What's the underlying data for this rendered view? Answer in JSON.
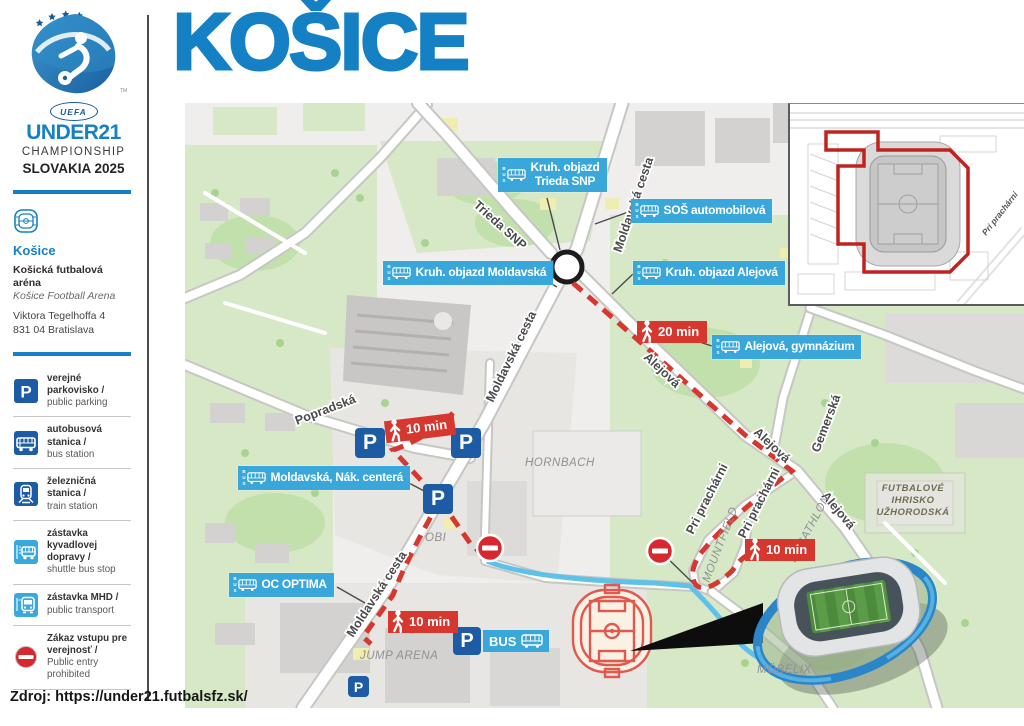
{
  "title": "KOŠICE",
  "footer": {
    "source": "Zdroj: https://under21.futbalsfz.sk/"
  },
  "sidebar": {
    "logo": {
      "uefa": "UEFA",
      "competition": "UNDER21",
      "subtitle": "CHAMPIONSHIP",
      "edition": "SLOVAKIA 2025",
      "trademark": "TM"
    },
    "venue": {
      "city": "Košice",
      "name_sk": "Košická futbalová aréna",
      "name_en": "Košice Football Arena",
      "address_line1": "Viktora Tegelhoffa 4",
      "address_line2": "831 04 Bratislava"
    },
    "legend": {
      "items": [
        {
          "icon": "parking-icon",
          "label_sk": "verejné parkovisko /",
          "label_en": "public parking"
        },
        {
          "icon": "bus-station-icon",
          "label_sk": "autobusová stanica /",
          "label_en": "bus station"
        },
        {
          "icon": "train-station-icon",
          "label_sk": "železničná stanica /",
          "label_en": "train station"
        },
        {
          "icon": "shuttle-bus-stop-icon",
          "label_sk": "zástavka kyvadlovej dopravy /",
          "label_en": "shuttle bus stop"
        },
        {
          "icon": "public-transport-icon",
          "label_sk": "zástavka MHD /",
          "label_en": "public transport"
        },
        {
          "icon": "no-entry-icon",
          "label_sk": "Zákaz vstupu pre verejnosť /",
          "label_en": "Public entry prohibited"
        }
      ]
    }
  },
  "map": {
    "bus_icon_letters": "BUS",
    "parking": {
      "p": "P",
      "bus": "BUS"
    },
    "stops": {
      "trieda_snp": {
        "line1": "Kruh. objazd",
        "line2": "Trieda SNP"
      },
      "sos_automobilova": {
        "line1": "SOŠ automobilová"
      },
      "kruh_moldavska": {
        "line1": "Kruh. objazd Moldavská"
      },
      "kruh_alejova": {
        "line1": "Kruh. objazd Alejová"
      },
      "alejova_gymnazium": {
        "line1": "Alejová, gymnázium"
      },
      "moldavska_nak_centera": {
        "line1": "Moldavská, Nák. centerá"
      },
      "oc_optima": {
        "line1": "OC OPTIMA"
      }
    },
    "badges": {
      "walk20": "20 min",
      "walk10_popradska": "10 min",
      "walk10_decathlon": "10 min",
      "walk10_jump": "10 min"
    },
    "streets": {
      "trieda_snp": "Trieda SNP",
      "moldavska_top": "Moldavská cesta",
      "moldavska_mid": "Moldavská cesta",
      "moldavska_low": "Moldavská cesta",
      "popradska": "Popradská",
      "alejova_upper": "Alejová",
      "alejova_mid": "Alejová",
      "alejova_lower": "Alejová",
      "gemerska": "Gemerská",
      "pri_pracharni_west": "Pri prachárni",
      "pri_pracharni_east": "Pri prachárni"
    },
    "places": {
      "hornbach": "HORNBACH",
      "obi": "OBI",
      "jump_arena": "JUMP ARENA",
      "mountfield": "MOUNTFIELD",
      "decathlon": "DECATHLON",
      "mobelix": "MÖBELIX",
      "futbalove_line1": "FUTBALOVÉ",
      "futbalove_line2": "IHRISKO",
      "futbalove_line3": "UŽHORODSKÁ"
    },
    "inset": {
      "street": "Pri prachárni"
    }
  },
  "colors": {
    "accent_blue": "#1580c4",
    "label_blue": "#39a7da",
    "sign_blue": "#1d5ca5",
    "route_red": "#d6372e",
    "shuttle_cyan": "#5fc0e8",
    "no_entry_red": "#d7282f"
  }
}
